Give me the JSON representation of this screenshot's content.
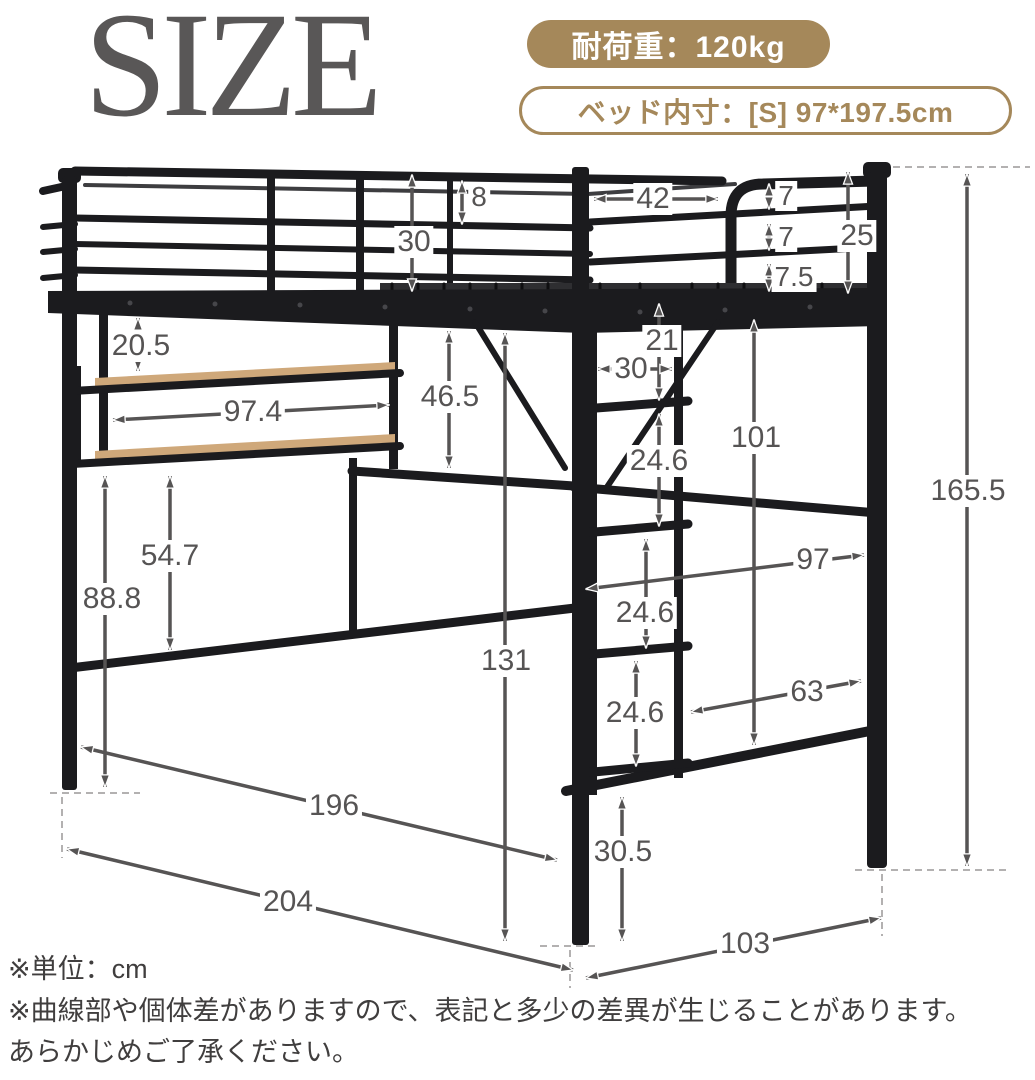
{
  "title": "SIZE",
  "badges": {
    "load_label": "耐荷重：120kg",
    "inner_label": "ベッド内寸：[S] 97*197.5cm"
  },
  "unit": "cm",
  "notes": [
    "※単位：cm",
    "※曲線部や個体差がありますので、表記と多少の差異が生じることがあります。",
    "あらかじめご了承ください。"
  ],
  "dimensions": {
    "rail_top_gap": "8",
    "guard_rail_height": "30",
    "ladder_opening_width": "42",
    "end_rail_gap_1": "7",
    "end_rail_gap_2": "7",
    "end_rail_gap_3": "7.5",
    "end_rail_height": "25",
    "shelf_clearance": "20.5",
    "shelf_width": "97.4",
    "under_rail_clearance": "46.5",
    "ladder_first_step": "21",
    "ladder_width": "30",
    "under_frame_height": "101",
    "ladder_step_1": "24.6",
    "ladder_step_2": "24.6",
    "ladder_step_3": "24.6",
    "bed_inner_width": "97",
    "frame_inner_width": "63",
    "desk_rail_height": "54.7",
    "shelf_floor_height": "88.8",
    "under_bed_clearance": "131",
    "total_height": "165.5",
    "leg_height": "30.5",
    "inner_length": "196",
    "outer_length": "204",
    "depth": "103"
  },
  "colors": {
    "accent_gold": "#a5885a",
    "title_gray": "#595757",
    "dimension_gray": "#565454",
    "bed_black": "#1b1b1e",
    "wood_tan": "#c9a179"
  }
}
